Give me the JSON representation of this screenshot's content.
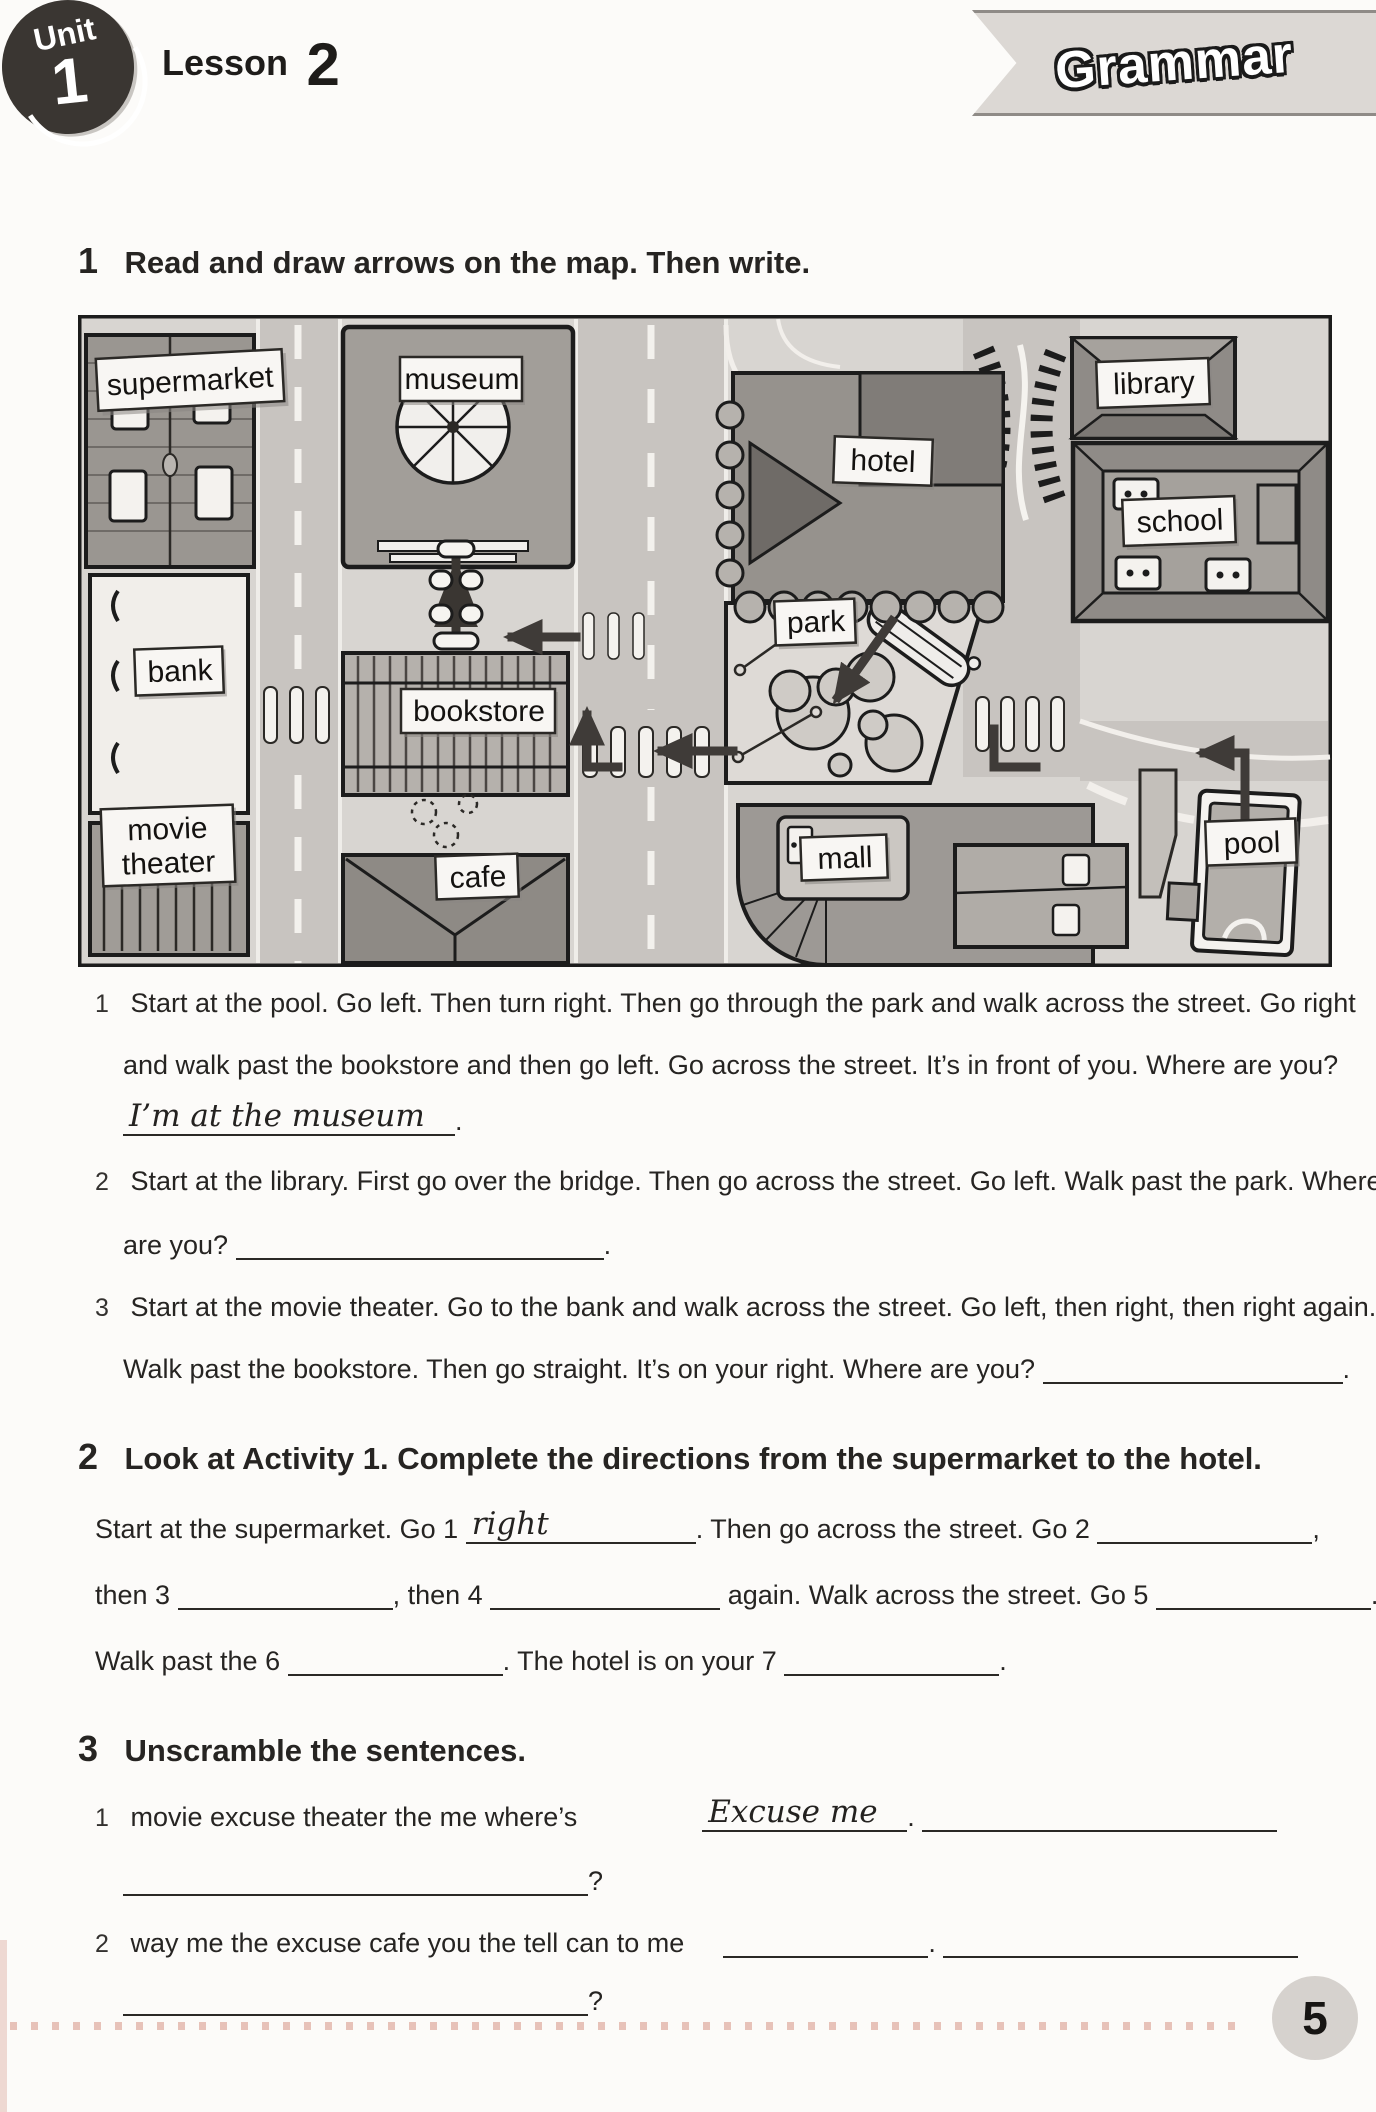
{
  "page": {
    "number": "5"
  },
  "header": {
    "unit_word": "Unit",
    "unit_number": "1",
    "lesson_word": "Lesson",
    "lesson_number": "2",
    "badge": "Grammar"
  },
  "activity1": {
    "number": "1",
    "title": "Read and draw arrows on the map. Then write.",
    "map_labels": {
      "supermarket": "supermarket",
      "museum": "museum",
      "hotel": "hotel",
      "library": "library",
      "school": "school",
      "park": "park",
      "bank": "bank",
      "bookstore": "bookstore",
      "movie": [
        "movie",
        "theater"
      ],
      "cafe": "cafe",
      "mall": "mall",
      "pool": "pool"
    },
    "q1": {
      "num": "1",
      "line1": "Start at the pool. Go left. Then turn right. Then go through the park and walk across the street. Go right",
      "line2": "and walk past the bookstore and then go left. Go across the street. It’s in front of you. Where are you?",
      "answer": "I’m at the museum",
      "period": "."
    },
    "q2": {
      "num": "2",
      "line1": "Start at the library. First go over the bridge. Then go across the street. Go left. Walk past the park. Where",
      "line2": "are you?",
      "period": "."
    },
    "q3": {
      "num": "3",
      "line1": "Start at the movie theater. Go to the bank and walk across the street. Go left, then right, then right again.",
      "line2": "Walk past the bookstore. Then go straight. It’s on your right. Where are you?",
      "period": "."
    }
  },
  "activity2": {
    "number": "2",
    "title": "Look at Activity 1. Complete the directions from the supermarket to the hotel.",
    "l1a": "Start at the supermarket. Go 1",
    "b1_handwritten": "right",
    "l1b": ". Then go across the street. Go 2",
    "l1c": ",",
    "l2a": "then 3",
    "l2b": ", then 4",
    "l2c": "again. Walk across the street. Go 5",
    "l2d": ".",
    "l3a": "Walk past the 6",
    "l3b": ". The hotel is on your 7",
    "l3c": "."
  },
  "activity3": {
    "number": "3",
    "title": "Unscramble the sentences.",
    "item1": {
      "num": "1",
      "scramble": "movie excuse theater the me where’s",
      "handwritten": "Excuse me",
      "period": ".",
      "qmark": "?"
    },
    "item2": {
      "num": "2",
      "scramble": "way me the excuse cafe you the tell can to me",
      "period": ".",
      "qmark": "?"
    }
  }
}
